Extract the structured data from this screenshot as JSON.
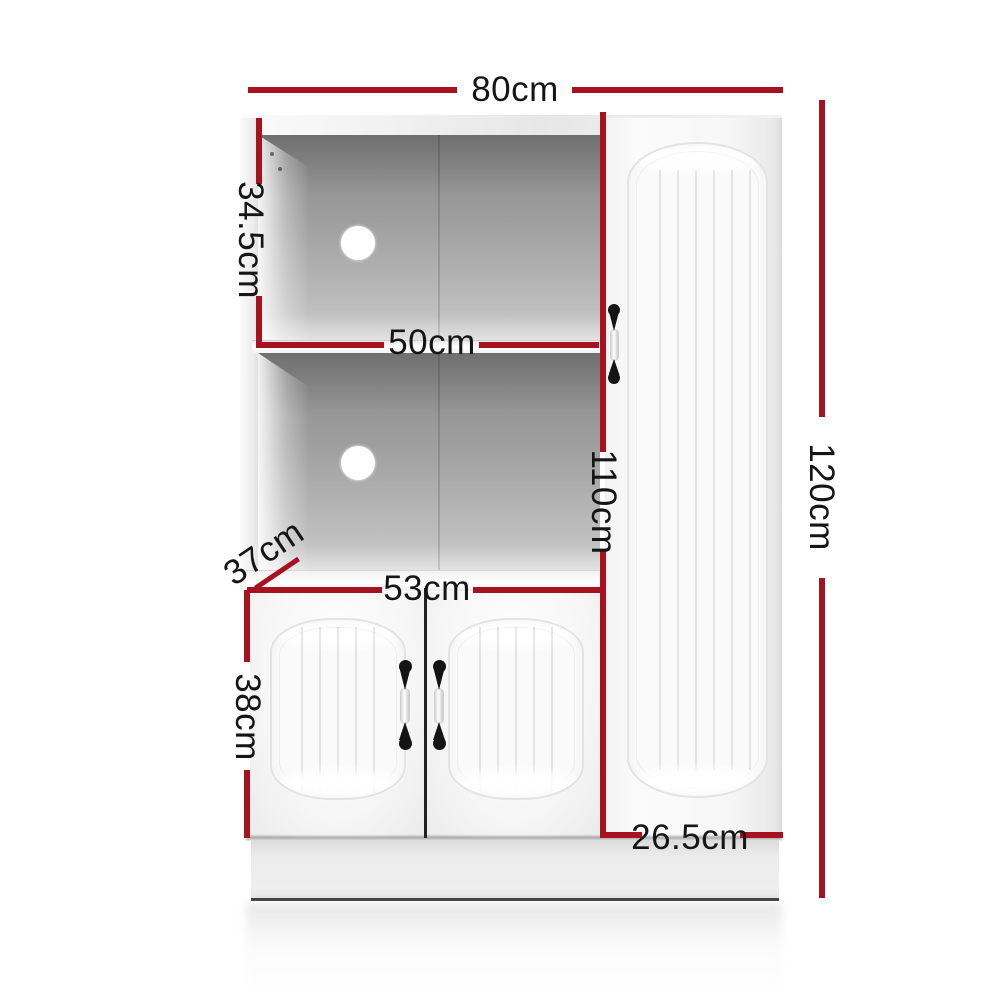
{
  "diagram": {
    "type": "furniture-dimension-diagram",
    "product": "White buffet sideboard cabinet with open shelves, two lower doors and tall side door",
    "unit": "cm",
    "accent_color": "#A6121F",
    "text_color": "#151515",
    "background_color": "#FFFFFF",
    "measurements": {
      "overall_width": "80cm",
      "upper_shelf_height": "34.5cm",
      "shelf_width": "50cm",
      "left_section_height": "110cm",
      "overall_height": "120cm",
      "depth": "37cm",
      "bottom_doors_width": "53cm",
      "bottom_doors_height": "38cm",
      "tall_door_width": "26.5cm"
    }
  }
}
